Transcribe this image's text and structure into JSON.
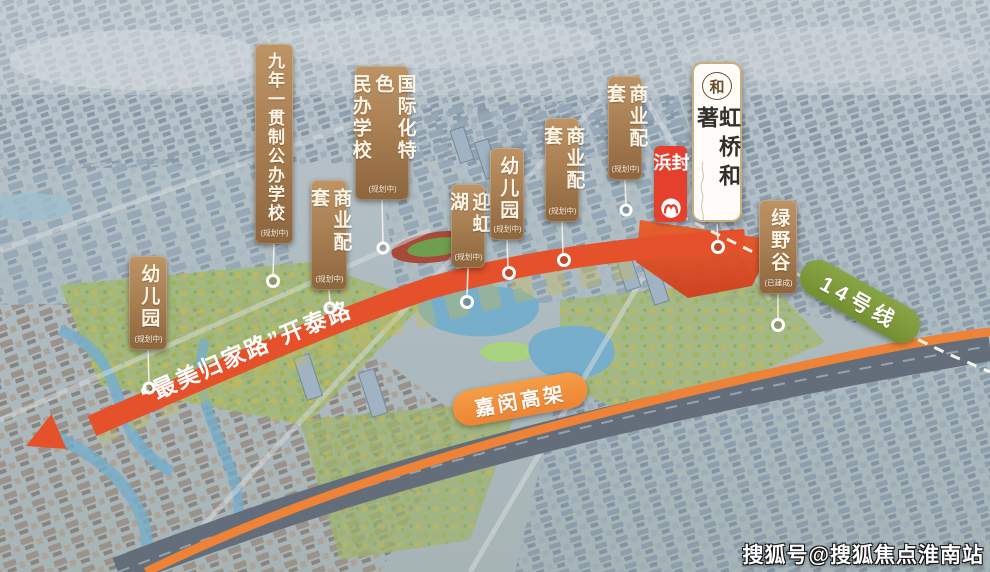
{
  "landmarks": [
    {
      "label": "九年一贯制公办学校",
      "status": "(规划中)"
    },
    {
      "label": "国际化特色\n民办学校",
      "status": "(规划中)"
    },
    {
      "label": "商业配套",
      "status": "(规划中)"
    },
    {
      "label": "幼儿园",
      "status": "(规划中)"
    },
    {
      "label": "迎虹湖",
      "status": "(规划中)"
    },
    {
      "label": "幼儿园",
      "status": "(规划中)"
    },
    {
      "label": "商业配套",
      "status": "(规划中)"
    },
    {
      "label": "商业配套",
      "status": "(规划中)"
    },
    {
      "label": "绿野谷",
      "status": "(已建成)"
    }
  ],
  "project": {
    "name": "虹桥和著",
    "logo_glyph": "和"
  },
  "metro": {
    "station": "封浜",
    "line_badge": "14号线",
    "logo_icon": "shanghai-metro-icon"
  },
  "roads": {
    "kaitai": "“最美归家路”开泰路",
    "viaduct": "嘉闵高架"
  },
  "watermark": "搜狐号@搜狐焦点淮南站",
  "colors": {
    "label_bronze": "#a57b50",
    "site_red": "#dd4a22",
    "road_orange": "#e4512a",
    "line14_green": "#7d9a3a",
    "viaduct_orange": "#f0923f",
    "station_red": "#e5402d"
  }
}
